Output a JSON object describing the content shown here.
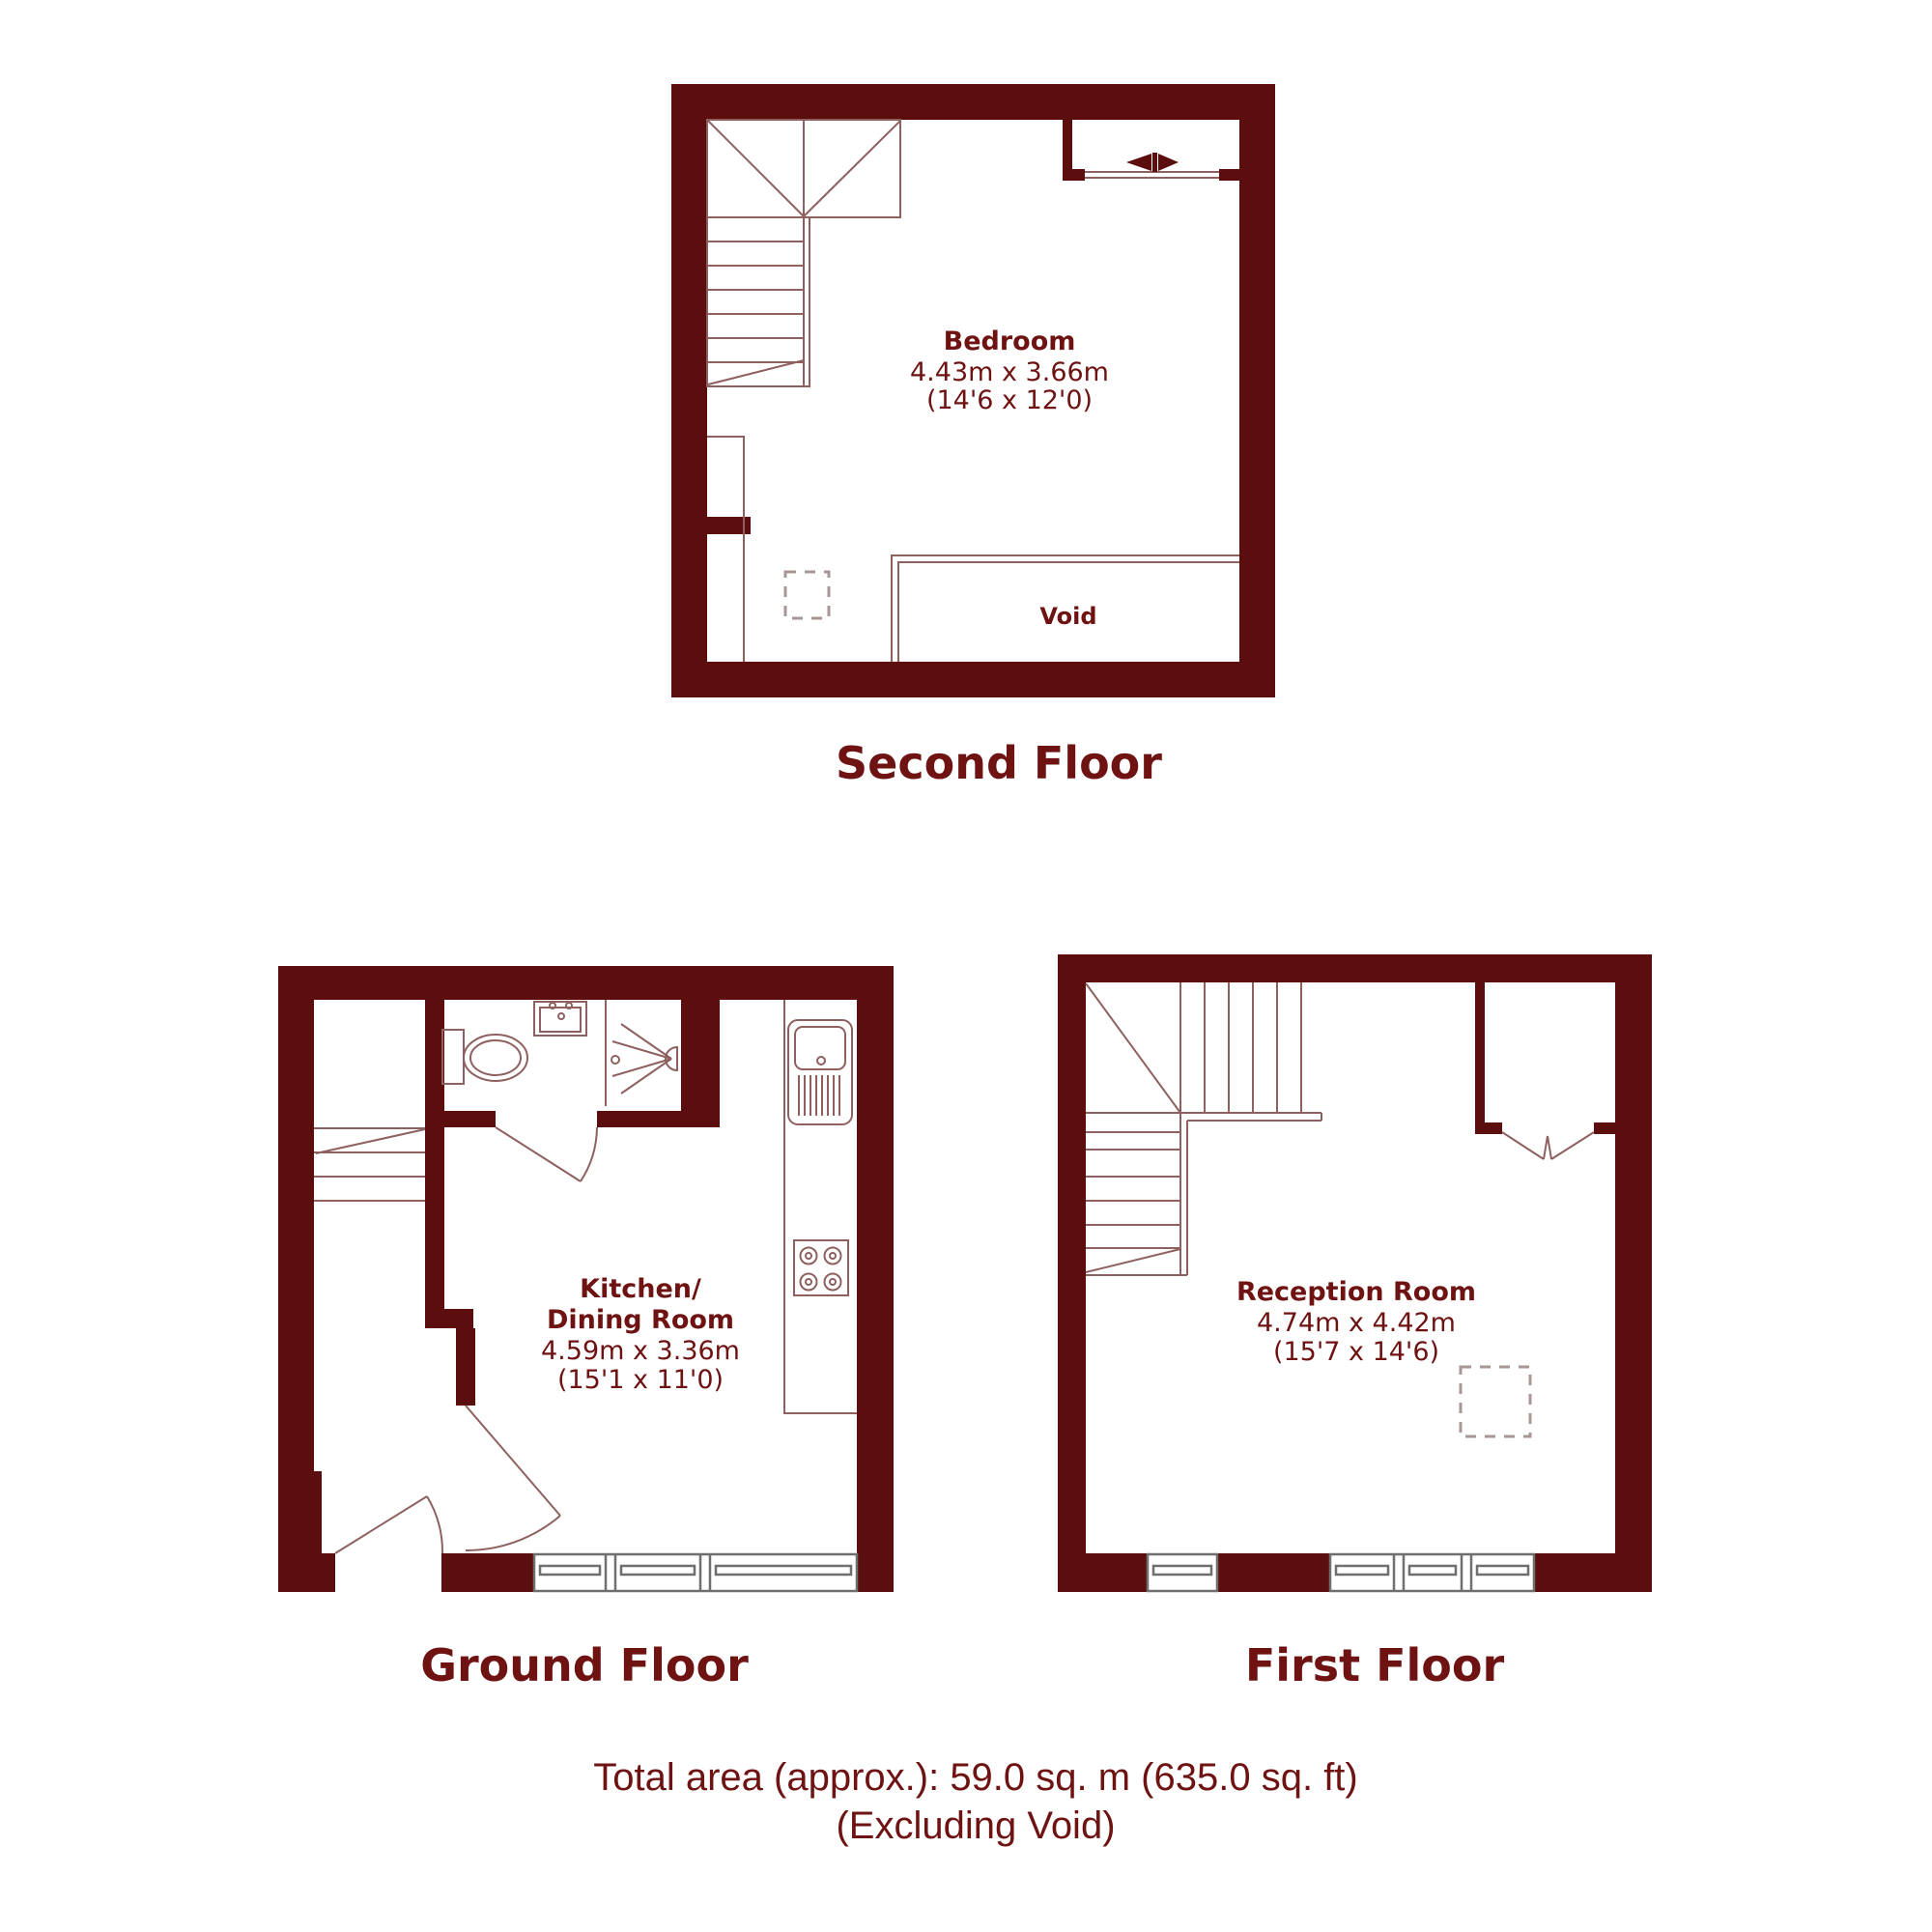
{
  "colors": {
    "wall": "#5C0E0E",
    "thin_line": "#8E6060",
    "text": "#6E1212",
    "window_line": "#6F6F6F",
    "dashed_marker": "#A89595",
    "background": "#FFFFFF"
  },
  "floors": {
    "second": {
      "label": "Second Floor",
      "room": {
        "name": "Bedroom",
        "metric": "4.43m x 3.66m",
        "imperial": "(14'6 x 12'0)"
      },
      "void_label": "Void"
    },
    "ground": {
      "label": "Ground Floor",
      "room": {
        "name_line1": "Kitchen/",
        "name_line2": "Dining Room",
        "metric": "4.59m x 3.36m",
        "imperial": "(15'1 x 11'0)"
      }
    },
    "first": {
      "label": "First Floor",
      "room": {
        "name": "Reception Room",
        "metric": "4.74m x 4.42m",
        "imperial": "(15'7 x 14'6)"
      }
    }
  },
  "footer": {
    "total_area": "Total area (approx.): 59.0 sq. m (635.0 sq. ft)",
    "note": "(Excluding Void)"
  }
}
